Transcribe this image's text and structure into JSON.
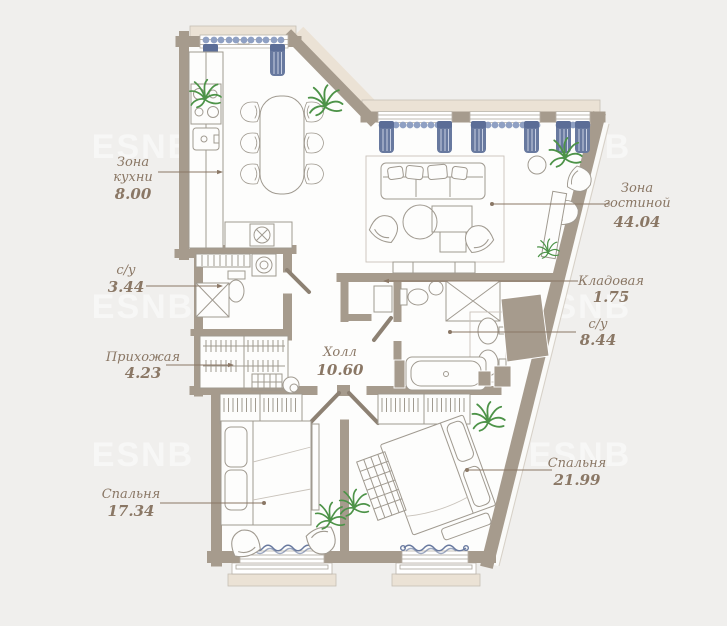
{
  "plan": {
    "rooms": {
      "kitchen": {
        "name_line1": "Зона",
        "name_line2": "кухни",
        "area": "8.00"
      },
      "living": {
        "name_line1": "Зона",
        "name_line2": "гостиной",
        "area": "44.04"
      },
      "bath_small": {
        "name": "с/у",
        "area": "3.44"
      },
      "storage": {
        "name": "Кладовая",
        "area": "1.75"
      },
      "bath_big": {
        "name": "с/у",
        "area": "8.44"
      },
      "entry": {
        "name": "Прихожая",
        "area": "4.23"
      },
      "hall": {
        "name": "Холл",
        "area": "10.60"
      },
      "bedroom_left": {
        "name": "Спальня",
        "area": "17.34"
      },
      "bedroom_right": {
        "name": "Спальня",
        "area": "21.99"
      }
    },
    "watermark": {
      "text": "ESNB"
    },
    "colors": {
      "background": "#f0efed",
      "floor": "#fdfdfc",
      "wall": "#a69b8d",
      "sill": "#ebe2d5",
      "furn": "#a09a90",
      "label": "#8a7765",
      "curtain": "#68799f",
      "curtain_light": "#8fa0c3",
      "plant": "#4d9348",
      "wm": "#ffffff"
    }
  }
}
